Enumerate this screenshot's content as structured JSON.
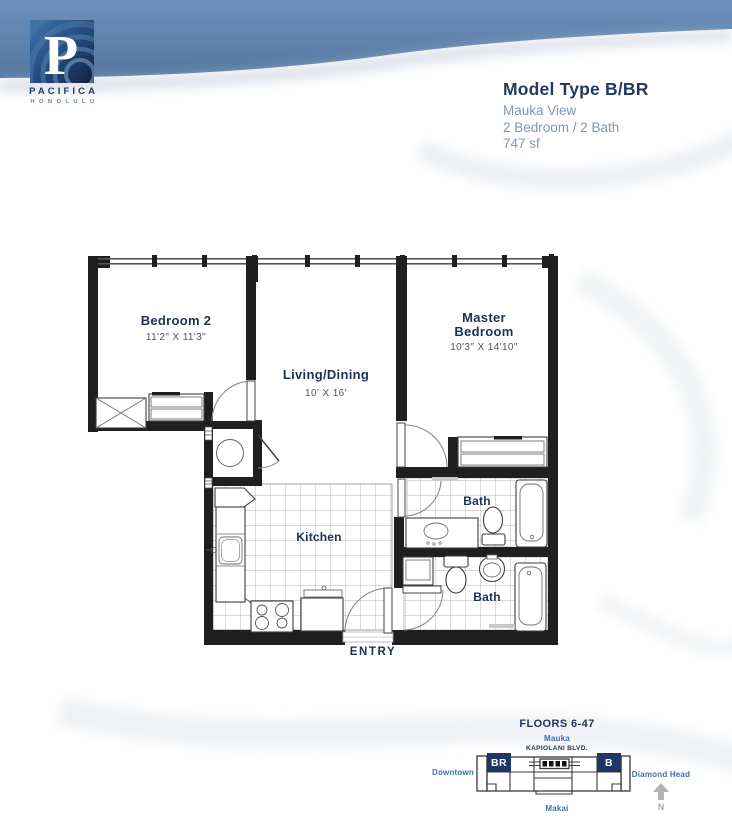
{
  "brand": {
    "monogram": "P",
    "name": "PACIFICA",
    "city": "HONOLULU"
  },
  "title_block": {
    "model": "Model Type B/BR",
    "view": "Mauka View",
    "config": "2 Bedroom / 2 Bath",
    "area": "747 sf"
  },
  "floorplan": {
    "rooms": {
      "bedroom2": {
        "name": "Bedroom 2",
        "dims": "11'2\" X 11'3\""
      },
      "living": {
        "name": "Living/Dining",
        "dims": "10' X 16'"
      },
      "master": {
        "line1": "Master",
        "line2": "Bedroom",
        "dims": "10'3\" X 14'10\""
      },
      "kitchen": {
        "name": "Kitchen"
      },
      "bath_upper": {
        "name": "Bath"
      },
      "bath_lower": {
        "name": "Bath"
      }
    },
    "entry": "ENTRY"
  },
  "keyplan": {
    "floors": "FLOORS 6-47",
    "mauka": "Mauka",
    "street": "KAPIOLANI BLVD.",
    "downtown": "Downtown",
    "diamond_head": "Diamond Head",
    "makai": "Makai",
    "unit_br": "BR",
    "unit_b": "B",
    "north": "N"
  },
  "colors": {
    "band_blue": "#5d82b2",
    "navy": "#22365c",
    "label_blue": "#3f6fae",
    "light_text": "#8295b5",
    "wall": "#1f1f1f",
    "logo_navy": "#16294a"
  }
}
